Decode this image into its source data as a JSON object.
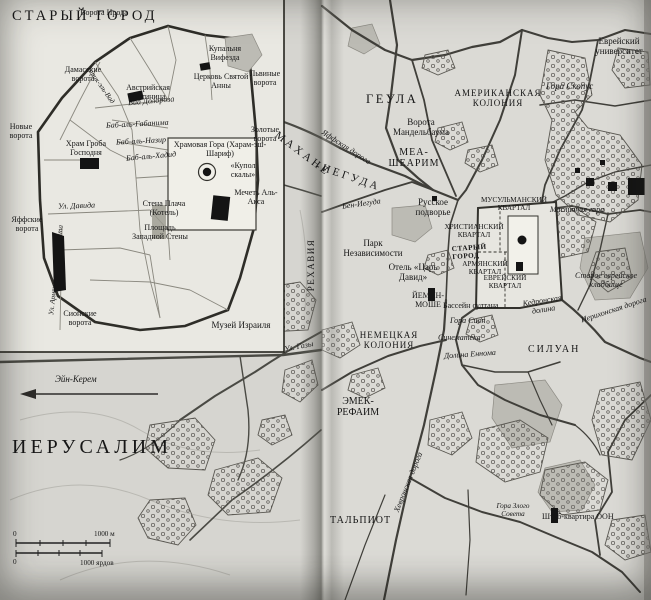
{
  "inset": {
    "title": "СТАРЫЙ ГОРОД",
    "labels": {
      "herod_gate": "Ворота Ирода",
      "damascus_gate": "Дамасские ворота",
      "austrian_hospice": "Австрийская гостиница",
      "bethesda_pool": "Купальня Вифезда",
      "st_anne_church": "Церковь Святой Анны",
      "lions_gate": "Львиные ворота",
      "via_dolorosa": "Виа Долороза",
      "tariq_el_wad": "Тарик-эль-Вад",
      "bab_al_ghawanima": "Баб-аль-Габанима",
      "bab_al_nazir": "Баб-аль-Назир",
      "bab_al_hadid": "Баб-аль-Хадид",
      "new_gate": "Новые ворота",
      "holy_sepulchre": "Храм Гроба Господня",
      "golden_gate": "Золотые ворота",
      "temple_mount": "Храмовая Гора (Харам-эш-Шариф)",
      "dome_of_rock": "«Купол скалы»",
      "western_wall": "Стена Плача (Котель)",
      "western_wall_plaza": "Площадь Западной Стены",
      "al_aqsa": "Мечеть Аль-Акса",
      "david_st": "Ул. Давида",
      "jaffa_gate": "Яффские ворота",
      "armenian_patriarchate_st": "Ул. Армянского патриархата",
      "zion_gate": "Сионские ворота"
    }
  },
  "west": {
    "city_title": "ИЕРУСАЛИМ",
    "labels": {
      "mahane": "МАХАНЕ",
      "yehuda": "-ИЕГУДА",
      "rehavia": "РЕХАВИЯ",
      "israel_museum": "Музей Израиля",
      "gaza_st": "Ул. Газы",
      "ein_kerem": "Эйн-Керем"
    },
    "scale": {
      "zero_m": "0",
      "max_m": "1000 м",
      "zero_yd": "0",
      "max_yd": "1000 ярдов"
    }
  },
  "east": {
    "labels": {
      "geula": "ГЕУЛА",
      "jaffa_road": "Яффская дорога",
      "american_colony": "АМЕРИКАНСКАЯ КОЛОНИЯ",
      "mandelbaum_gate": "Ворота Мандельбаума",
      "mea_shearim": "МЕА-ШЕАРИМ",
      "hebrew_university": "Еврейский университет",
      "mount_scopus": "Гора Скопус",
      "ben_yehuda": "Бен-Иегуда",
      "russian_compound": "Русское подворье",
      "muslim_quarter": "МУСУЛЬМАНСКИЙ КВАРТАЛ",
      "christian_quarter": "ХРИСТИАНСКИЙ КВАРТАЛ",
      "old_city": "СТАРЫЙ ГОРОД",
      "armenian_quarter": "АРМЯНСКИЙ КВАРТАЛ",
      "jewish_quarter": "ЕВРЕЙСКИЙ КВАРТАЛ",
      "mount_of_olives": "Масличная гора",
      "old_jewish_cemetery": "Старое еврейское кладбище",
      "independence_park": "Парк Независимости",
      "king_david_hotel": "Отель «Царь Давид»",
      "yemin_moshe": "ЙЕМИН-МОШЕ",
      "sultans_pool": "Бассейн султана",
      "mount_zion": "Гора Сион",
      "cinematheque": "Синематека",
      "hinnom_valley": "Долина Еннома",
      "kidron_valley": "Кедронская долина",
      "jericho_road": "Иерихонская дорога",
      "silwan": "СИЛУАН",
      "german_colony": "НЕМЕЦКАЯ КОЛОНИЯ",
      "emek_refaim": "ЭМЕК-РЕФАИМ",
      "talpiot": "ТАЛЬПИОТ",
      "hebron_road": "Хевронская дорога",
      "hill_of_evil_counsel": "Гора Злого Совета",
      "un_headquarters": "Штаб-квартира ООН"
    }
  }
}
